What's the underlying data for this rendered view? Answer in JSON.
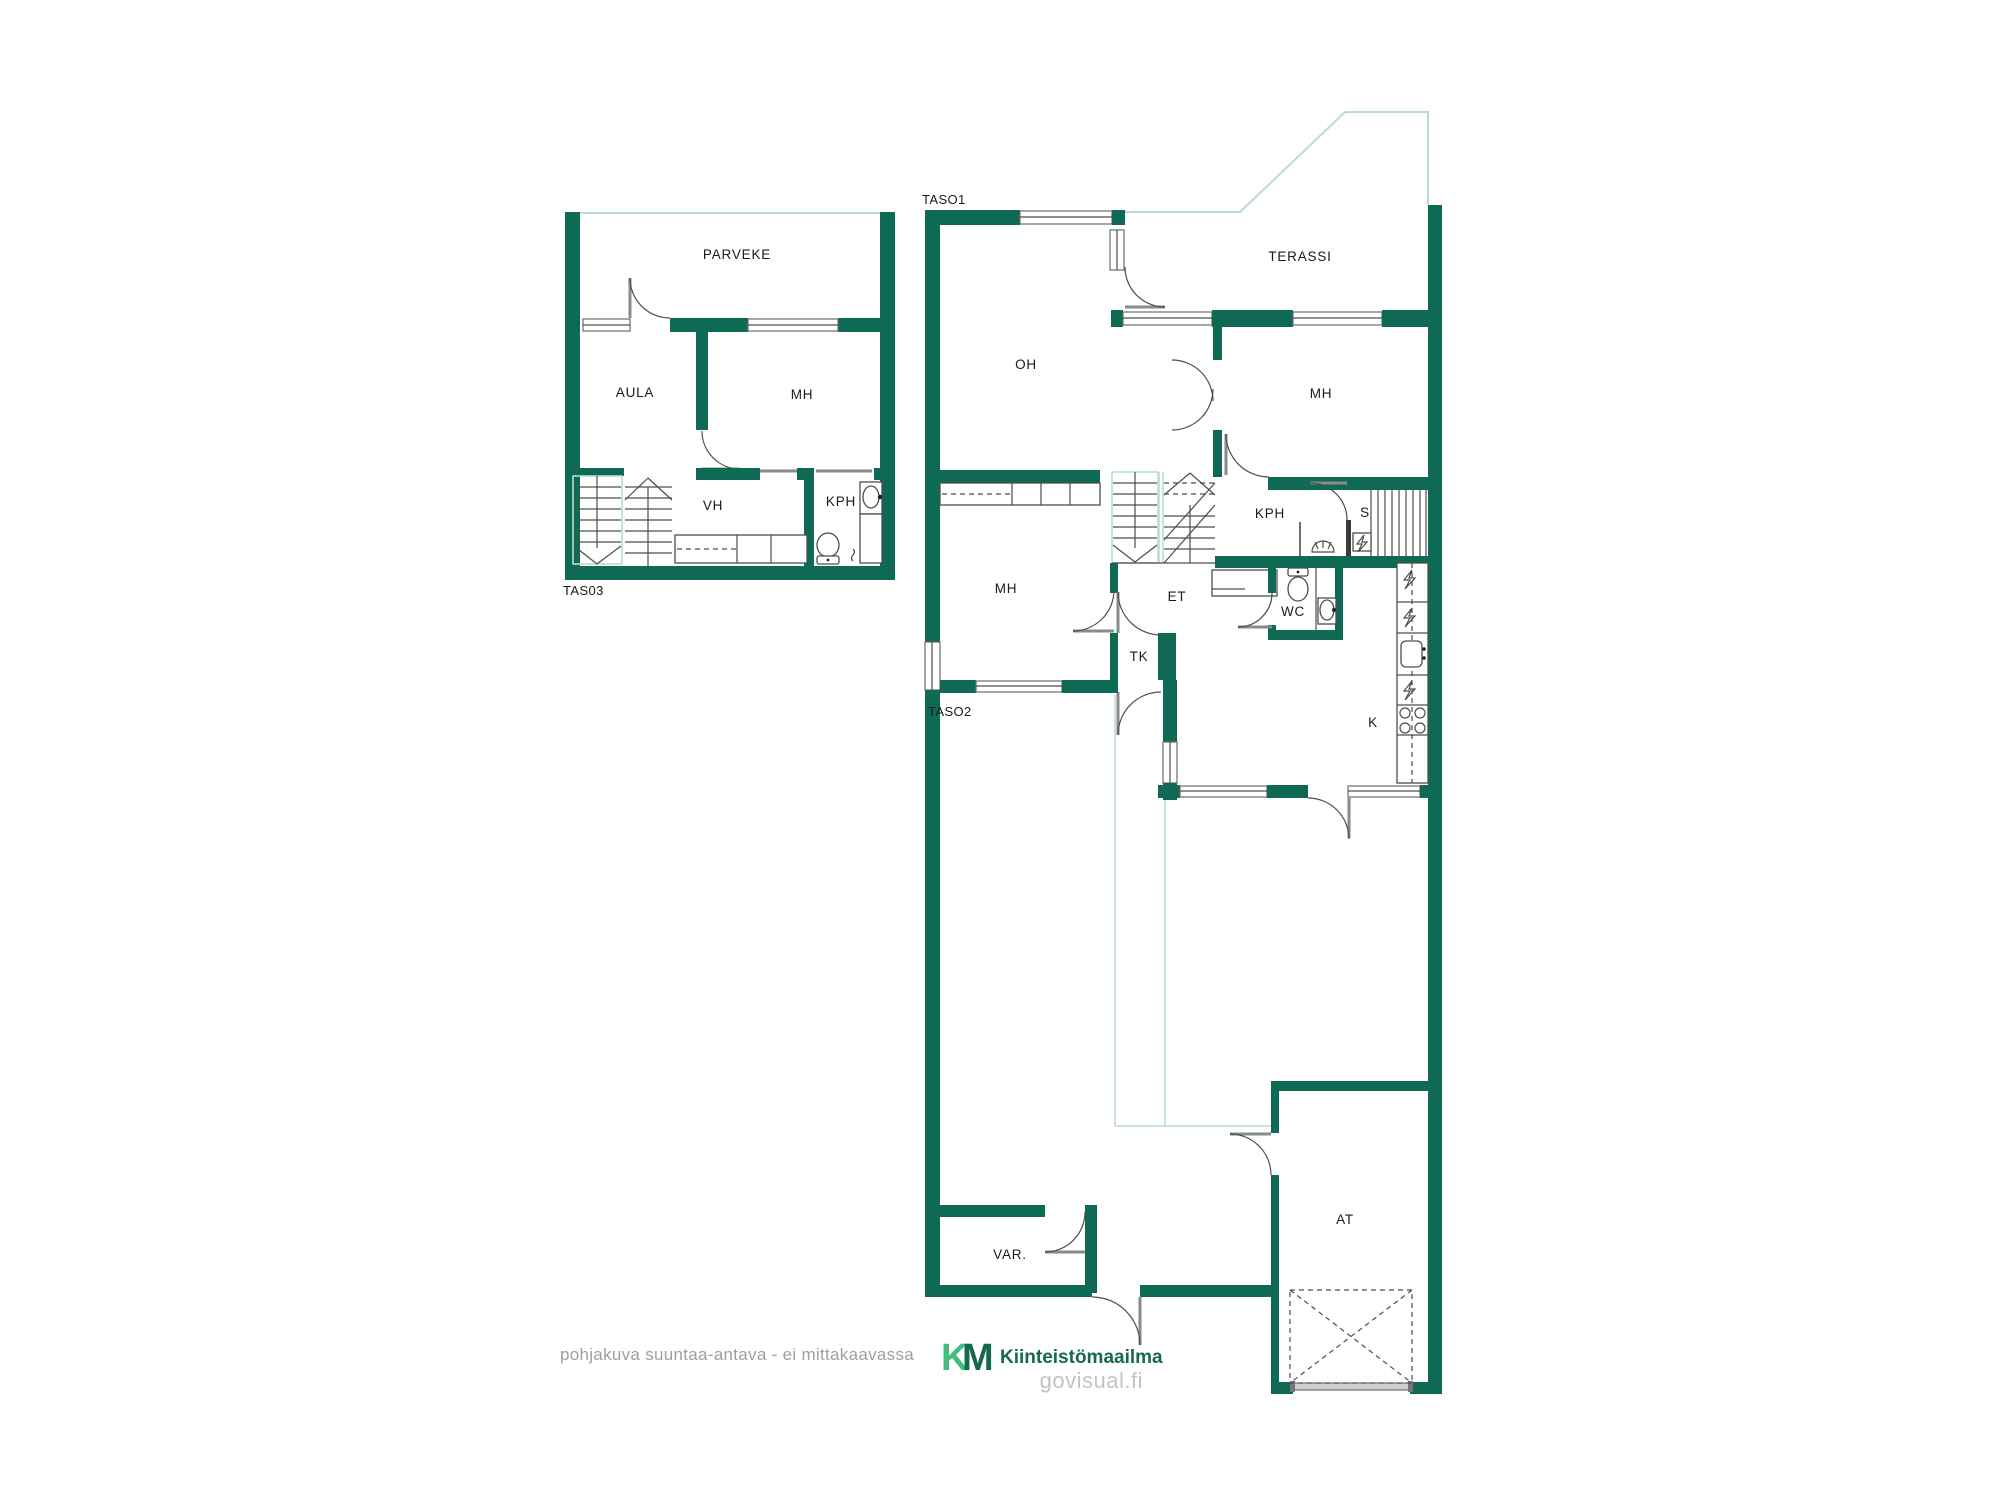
{
  "colors": {
    "wall": "#0f6a55",
    "outline": "#b7ddd2",
    "line": "#4d4d4d",
    "text": "#1a1a1a",
    "muted": "#9aa0a6",
    "brand_light": "#3fbe7d",
    "brand_dark": "#156a4e",
    "site": "#c0c4c8"
  },
  "levels": {
    "tas03": {
      "label": "TAS03",
      "rooms": {
        "parveke": "PARVEKE",
        "aula": "AULA",
        "mh": "MH",
        "vh": "VH",
        "kph": "KPH"
      }
    },
    "taso1": {
      "label": "TASO1",
      "rooms": {
        "terassi": "TERASSI",
        "oh": "OH",
        "mh": "MH",
        "kph": "KPH",
        "s": "S"
      }
    },
    "taso2": {
      "label": "TASO2",
      "rooms": {
        "mh": "MH",
        "et": "ET",
        "tk": "TK",
        "wc": "WC",
        "k": "K",
        "var": "VAR.",
        "at": "AT"
      }
    }
  },
  "footer": {
    "disclaimer": "pohjakuva suuntaa-antava - ei mittakaavassa",
    "brand_k": "K",
    "brand_m": "M",
    "brand_name": "Kiinteistömaailma",
    "site": "govisual.fi"
  }
}
